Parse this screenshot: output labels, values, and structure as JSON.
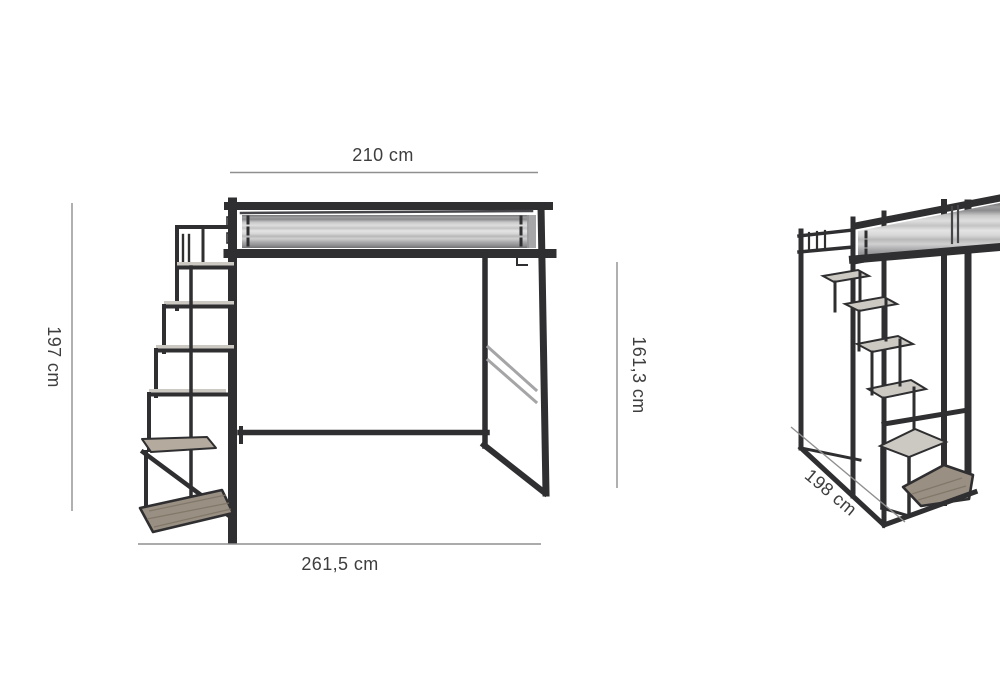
{
  "page": {
    "background": "#ffffff",
    "subject": "loft-bed-with-staircase-dimension-diagram"
  },
  "dimensions": {
    "top_width": "210 cm",
    "left_height": "197 cm",
    "right_height": "161,3 cm",
    "bottom_width": "261,5 cm",
    "side_depth": "198 cm"
  },
  "colors": {
    "frame": "#2f2f31",
    "frame_light": "#46464a",
    "brace": "#a5a5a7",
    "dimension_line": "#8f8f8f",
    "dimension_text": "#3e3e3e",
    "mattress_light": "#e4e4e5",
    "mattress_dark": "#707072",
    "step_top": "#ccc9c3",
    "wood": "#998f82",
    "wood_light": "#b4ab9e",
    "wood_grain": "#7e7466"
  }
}
